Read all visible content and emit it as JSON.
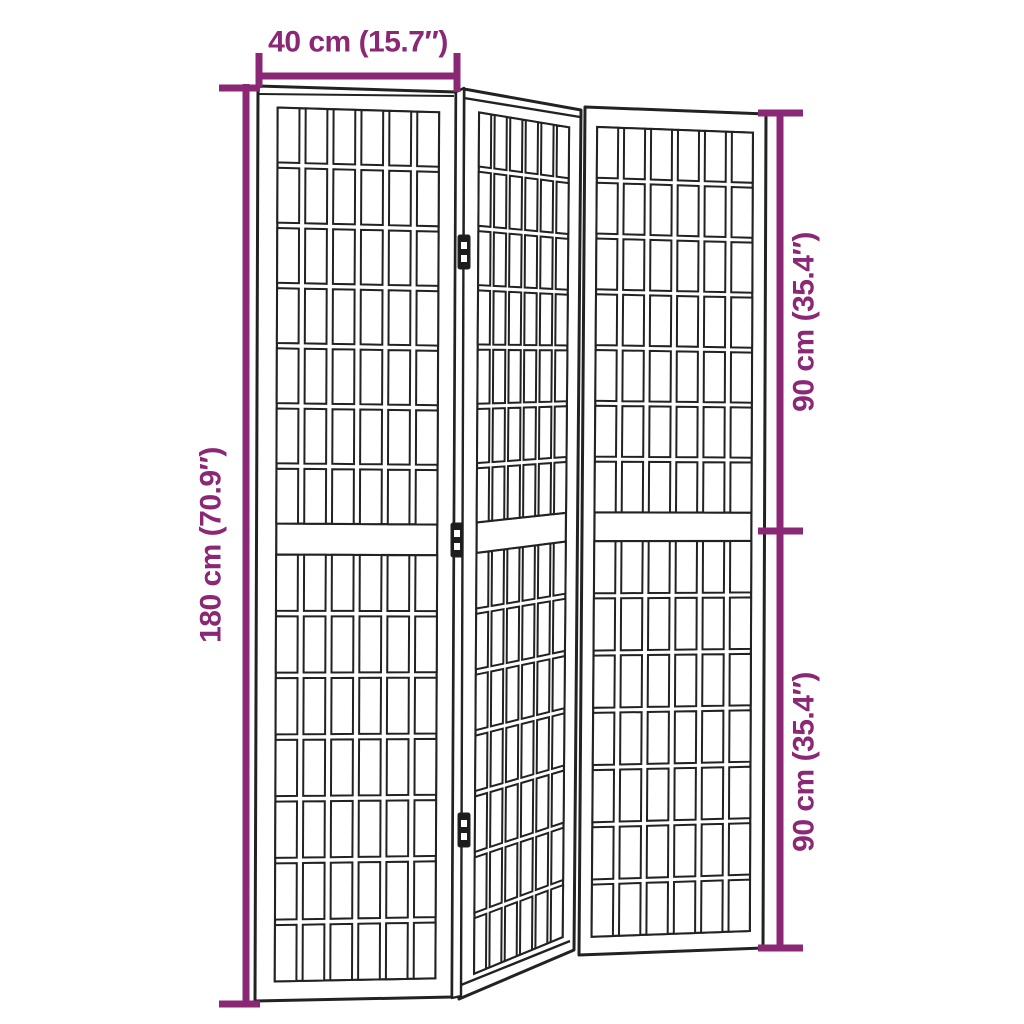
{
  "page": {
    "background": "#ffffff"
  },
  "figure": {
    "type": "product-dimension-diagram",
    "subject": "3-panel folding room divider with lattice grid panels",
    "colors": {
      "dimension": "#8B2876",
      "line": "#222222",
      "fill": "#ffffff",
      "hinge": "#1d1d1d"
    },
    "panels": [
      {
        "name": "panel-left",
        "quad": [
          [
            258,
            86
          ],
          [
            456,
            92
          ],
          [
            452,
            997
          ],
          [
            255,
            1001
          ]
        ],
        "inner_u": [
          0.1,
          0.915
        ],
        "sections": [
          [
            0.023,
            0.478
          ],
          [
            0.512,
            0.979
          ]
        ],
        "cols": 6,
        "rows": 7
      },
      {
        "name": "panel-middle",
        "quad": [
          [
            464,
            89
          ],
          [
            581,
            110
          ],
          [
            574,
            950
          ],
          [
            459,
            999
          ]
        ],
        "inner_u": [
          0.13,
          0.9
        ],
        "sections": [
          [
            0.023,
            0.478
          ],
          [
            0.512,
            0.979
          ]
        ],
        "cols": 6,
        "rows": 7
      },
      {
        "name": "panel-right",
        "quad": [
          [
            585,
            107
          ],
          [
            766,
            114
          ],
          [
            763,
            948
          ],
          [
            579,
            955
          ]
        ],
        "inner_u": [
          0.068,
          0.928
        ],
        "sections": [
          [
            0.023,
            0.478
          ],
          [
            0.512,
            0.979
          ]
        ],
        "cols": 6,
        "rows": 7
      }
    ],
    "grid_style": {
      "col_gap_frac": 0.23,
      "row_gap_frac": 0.09
    },
    "extras": {
      "side_strip": [
        [
          456,
          92
        ],
        [
          464,
          88
        ],
        [
          461,
          996
        ],
        [
          452,
          998
        ]
      ],
      "edge_lines": [
        {
          "name": "left-panel-top-edge",
          "pts": [
            [
              259,
              94
            ],
            [
              454,
              96
            ]
          ],
          "w": 2.0
        },
        {
          "name": "middle-panel-top-edge",
          "pts": [
            [
              464,
              98
            ],
            [
              580,
              117
            ]
          ],
          "w": 2.4
        },
        {
          "name": "middle-panel-bottom-edge",
          "pts": [
            [
              461,
              985
            ],
            [
              570,
              941
            ]
          ],
          "w": 2.4
        }
      ],
      "hinges": [
        {
          "cx": 464,
          "cy": 252
        },
        {
          "cx": 457,
          "cy": 540
        },
        {
          "cx": 464,
          "cy": 830
        }
      ]
    }
  },
  "dimensions": {
    "width": {
      "label": "40 cm (15.7″)",
      "value_cm": 40,
      "value_in": 15.7,
      "line": [
        259,
        76,
        457,
        76
      ],
      "ticks": [
        [
          259,
          53,
          259,
          88
        ],
        [
          457,
          53,
          457,
          92
        ]
      ],
      "label_pos": {
        "x": 358,
        "y": 41,
        "rotate": 0
      }
    },
    "height": {
      "label": "180 cm (70.9″)",
      "value_cm": 180,
      "value_in": 70.9,
      "line": [
        246,
        84,
        246,
        1005
      ],
      "ticks": [
        [
          219,
          88,
          260,
          88
        ],
        [
          219,
          1004,
          260,
          1004
        ]
      ],
      "label_pos": {
        "x": 210,
        "y": 545,
        "rotate": -90
      }
    },
    "panel_height_top": {
      "label": "90 cm (35.4″)",
      "value_cm": 90,
      "value_in": 35.4,
      "line": [
        780,
        113,
        780,
        531
      ],
      "ticks": [
        [
          758,
          113,
          803,
          113
        ],
        [
          758,
          531,
          803,
          531
        ]
      ],
      "label_pos": {
        "x": 803,
        "y": 322,
        "rotate": -90
      }
    },
    "panel_height_bottom": {
      "label": "90 cm (35.4″)",
      "value_cm": 90,
      "value_in": 35.4,
      "line": [
        780,
        531,
        780,
        948
      ],
      "ticks": [
        [
          758,
          948,
          803,
          948
        ]
      ],
      "label_pos": {
        "x": 803,
        "y": 762,
        "rotate": -90
      }
    }
  }
}
